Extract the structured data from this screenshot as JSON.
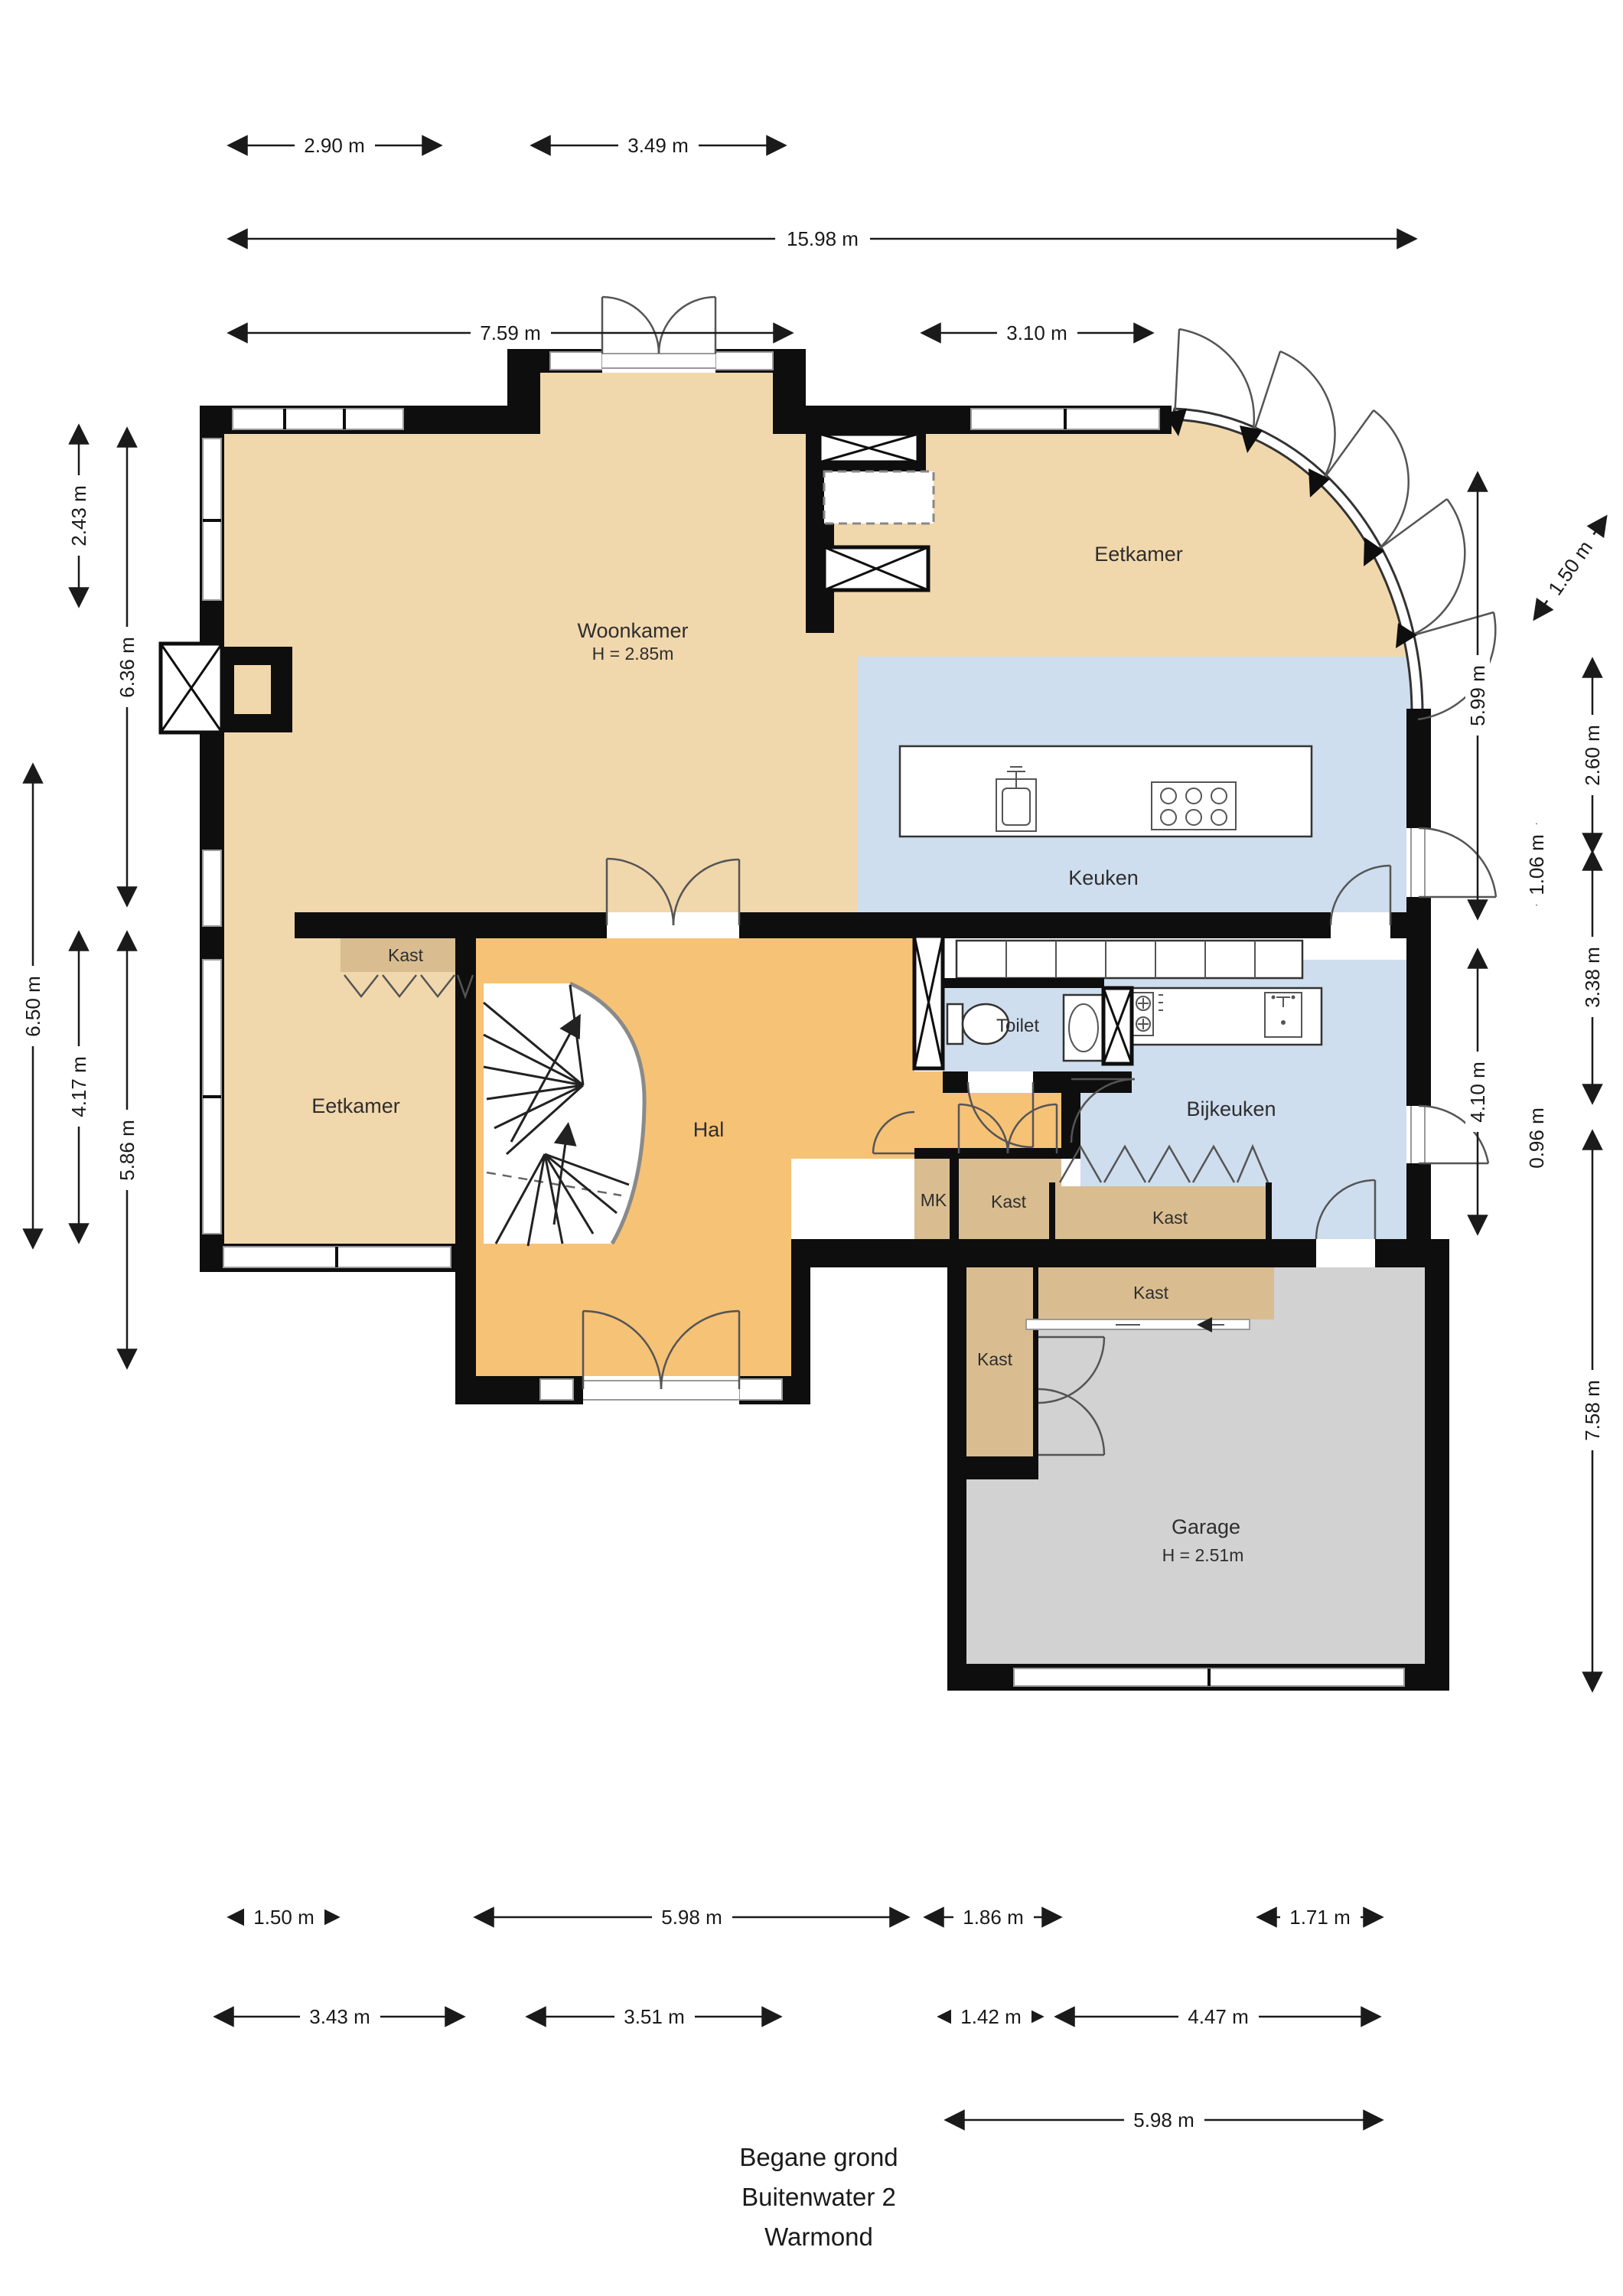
{
  "title": {
    "line1": "Begane grond",
    "line2": "Buitenwater 2",
    "line3": "Warmond"
  },
  "rooms": {
    "woonkamer": {
      "label": "Woonkamer",
      "height": "H = 2.85m"
    },
    "eetkamer_top": {
      "label": "Eetkamer"
    },
    "eetkamer_left": {
      "label": "Eetkamer"
    },
    "keuken": {
      "label": "Keuken"
    },
    "hal": {
      "label": "Hal"
    },
    "toilet": {
      "label": "Toilet"
    },
    "bijkeuken": {
      "label": "Bijkeuken"
    },
    "garage": {
      "label": "Garage",
      "height": "H = 2.51m"
    },
    "kast1": {
      "label": "Kast"
    },
    "kast2": {
      "label": "Kast"
    },
    "kast3": {
      "label": "Kast"
    },
    "kast4": {
      "label": "Kast"
    },
    "kast5": {
      "label": "Kast"
    },
    "mk": {
      "label": "MK"
    }
  },
  "dimensions": {
    "top": [
      {
        "label": "2.90 m"
      },
      {
        "label": "3.49 m"
      },
      {
        "label": "15.98 m"
      },
      {
        "label": "7.59 m"
      },
      {
        "label": "3.10 m"
      }
    ],
    "left": [
      {
        "label": "2.43 m"
      },
      {
        "label": "6.36 m"
      },
      {
        "label": "6.50 m"
      },
      {
        "label": "4.17 m"
      },
      {
        "label": "5.86 m"
      }
    ],
    "right": [
      {
        "label": "5.99 m"
      },
      {
        "label": "4.10 m"
      },
      {
        "label": "1.06 m"
      },
      {
        "label": "0.96 m"
      },
      {
        "label": "1.50 m"
      },
      {
        "label": "2.60 m"
      },
      {
        "label": "3.38 m"
      },
      {
        "label": "7.58 m"
      }
    ],
    "bottom": [
      {
        "label": "1.50 m"
      },
      {
        "label": "5.98 m"
      },
      {
        "label": "1.86 m"
      },
      {
        "label": "1.71 m"
      },
      {
        "label": "3.43 m"
      },
      {
        "label": "3.51 m"
      },
      {
        "label": "1.42 m"
      },
      {
        "label": "4.47 m"
      },
      {
        "label": "5.98 m"
      }
    ]
  },
  "colors": {
    "living_tan": "#f1d7ac",
    "closet_tan": "#d9bd90",
    "hall_orange": "#f6c276",
    "kitchen_blue": "#cfdeee",
    "garage_gray": "#d2d2d2",
    "wall_black": "#0e0e0e"
  }
}
